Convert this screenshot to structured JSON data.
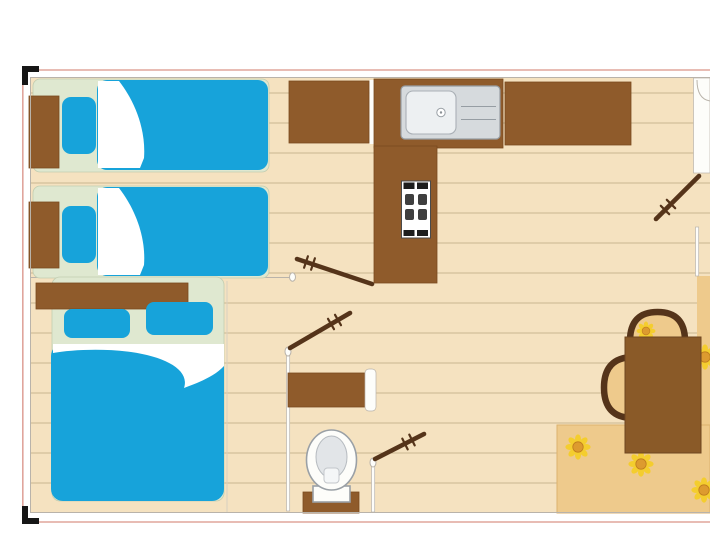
{
  "scene": {
    "kind": "floor-plan",
    "subject": "Mobile home / bungalow floor plan with two bedrooms, kitchen, WC and dining area",
    "visible_text": ""
  },
  "labels": {
    "plan": "Mobile home floor plan",
    "twin_bedroom": "Bedroom with two single beds",
    "double_bedroom": "Bedroom with double bed",
    "kitchen": "Kitchen",
    "bathroom": "WC",
    "living": "Living / dining area",
    "single_bed_top": "Single bed",
    "single_bed_bottom": "Single bed",
    "double_bed": "Double bed",
    "wardrobe": "Wardrobe unit",
    "counter_sink": "Kitchen counter with sink",
    "counter_right": "Kitchen counter",
    "counter_column": "Kitchen unit with cooktop",
    "sink": "Stainless sink with drainer",
    "cooktop": "Cooktop",
    "vanity": "Bathroom cabinet",
    "toilet": "Toilet",
    "table": "Dining table",
    "chair_top": "Chair",
    "chair_side": "Chair",
    "bench_strip": "Seat cushion",
    "rug": "Rug with sunflower pattern",
    "door_hall": "Interior door",
    "door_wc_top": "WC door",
    "door_wc_bottom": "Interior door",
    "entrance_door": "Entrance door",
    "entry": "Entry with door swing"
  },
  "colors": {
    "floor": "#f5e2c0",
    "plank": "#c9b691",
    "bed_base": "#dfe8d0",
    "bed_base_line": "#c2cdb0",
    "mattress": "#17a3da",
    "wood": "#8f5b2b",
    "wood_edge": "#7a4a1f",
    "wood_dark": "#55341a",
    "table": "#8a5a28",
    "table_edge": "#6f4520",
    "rug": "#eeca8c",
    "rug_edge": "#dcb26e",
    "petal": "#f4cd2e",
    "flower_center": "#dd9b2f",
    "flower_ring": "#bf7c1e",
    "steel": "#d6dadd",
    "steel_line": "#969da3",
    "sink_white": "#edf0f2",
    "white": "#fdfdfa",
    "wall_line": "#b9b3aa",
    "faint_line": "#d8d0c0",
    "border_pink": "#e0a59c",
    "corner": "#161616",
    "toilet_line": "#9aa0a6",
    "bowl": "#e2e5e8",
    "black": "#1d1d1d"
  }
}
